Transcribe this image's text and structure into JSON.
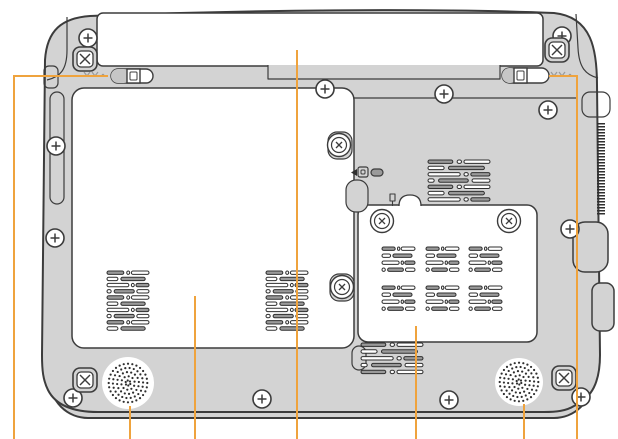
{
  "canvas": {
    "w": 618,
    "h": 439
  },
  "figure": {
    "name": "notebook-bottom-view-illustration"
  },
  "palette": {
    "body": "#d3d3d3",
    "outline": "#3c3c3c",
    "white": "#ffffff",
    "slot": "#9a9a9a",
    "knob_shade": "#c6c6c6",
    "dark": "#2f2f2f",
    "callout": "#efa33d"
  },
  "body": {
    "wall": {
      "x": 50,
      "y": 320,
      "w": 542,
      "h": 98,
      "r": 38
    },
    "outline_d": "M90,16 C250,10 430,8 554,13 C592,17 597,50 597,85 L600,355 C600,382 592,398 574,406 C566,411 556,412 544,412 L98,412 C74,412 56,406 48,390 C43,380 42,370 42,355 L45,60 C47,30 62,18 90,16 Z"
  },
  "battery": {
    "name": "battery-pack",
    "x": 97,
    "y": 13,
    "w": 446,
    "h": 53,
    "r": 6
  },
  "covers": [
    {
      "name": "hard-disk-compartment-cover",
      "x": 72,
      "y": 88,
      "w": 282,
      "h": 260,
      "r": 12
    },
    {
      "name": "memory-compartment-cover",
      "x": 358,
      "y": 205,
      "w": 179,
      "h": 137,
      "r": 10
    }
  ],
  "details_under": [
    {
      "name": "left-edge-tab",
      "type": "rrect",
      "x": 44,
      "y": 66,
      "w": 14,
      "h": 22,
      "r": 5,
      "sw": 1.2
    },
    {
      "name": "left-edge-strip",
      "type": "rrect",
      "x": 50,
      "y": 92,
      "w": 14,
      "h": 112,
      "r": 7,
      "sw": 1.2
    },
    {
      "name": "corner-contour-left",
      "type": "path",
      "d": "M67,17 L67,50 C67,70 60,77 47,80",
      "sw": 1.2
    },
    {
      "name": "corner-contour-right",
      "type": "path",
      "d": "M576,14 L578,48 C579,68 586,75 598,78",
      "sw": 1.2
    },
    {
      "name": "right-top-tab",
      "type": "rrect",
      "x": 582,
      "y": 92,
      "w": 28,
      "h": 25,
      "r": 8,
      "sw": 1.2
    },
    {
      "name": "right-side-ribs",
      "type": "ribs",
      "x": 597,
      "y": 123,
      "w": 8,
      "count": 31,
      "gap": 3
    },
    {
      "name": "right-bulge",
      "type": "rrect",
      "x": 573,
      "y": 222,
      "w": 35,
      "h": 50,
      "r": 12,
      "sw": 1.5,
      "fill": "body"
    },
    {
      "name": "right-lower-bulge",
      "type": "rrect",
      "x": 592,
      "y": 283,
      "w": 22,
      "h": 48,
      "r": 8,
      "sw": 1.5,
      "fill": "body"
    },
    {
      "name": "body-contour-right-of-cover",
      "type": "path",
      "d": "M342,88 L342,98 L576,98",
      "sw": 1.2
    }
  ],
  "details_over": [
    {
      "name": "battery-step",
      "type": "path",
      "d": "M268,65 L268,79 L500,79 L500,65",
      "sw": 1.2,
      "fill": "body",
      "fillclose": true
    },
    {
      "name": "cover-screw-boss-top",
      "type": "rrect",
      "x": 328,
      "y": 132,
      "w": 24,
      "h": 27,
      "r": 9,
      "sw": 1.2,
      "fill": "body"
    },
    {
      "name": "cover-screw-boss-bottom",
      "type": "rrect",
      "x": 330,
      "y": 274,
      "w": 24,
      "h": 27,
      "r": 9,
      "sw": 1.2,
      "fill": "body"
    },
    {
      "name": "thumb-recess",
      "type": "rrect",
      "x": 346,
      "y": 180,
      "w": 22,
      "h": 32,
      "r": 10,
      "sw": 1.2,
      "fill": "body"
    },
    {
      "name": "oval-tab",
      "type": "rrect",
      "x": 352,
      "y": 346,
      "w": 14,
      "h": 24,
      "r": 7,
      "sw": 1.2,
      "fill": "body"
    },
    {
      "name": "memory-cover-notch",
      "type": "path",
      "d": "M399,206 Q399,195 410,195 Q421,195 421,206",
      "sw": 1.3,
      "fill": "white"
    },
    {
      "name": "battery-lock-arrow-icon",
      "type": "path",
      "d": "M357,169 L351,172.5 L357,176 Z",
      "fill": "dark",
      "sw": 0
    },
    {
      "name": "battery-lock-box-icon",
      "type": "rrect",
      "x": 358,
      "y": 167,
      "w": 10,
      "h": 10,
      "r": 2,
      "sw": 1.2
    },
    {
      "name": "battery-lock-box-inner-icon",
      "type": "rrect",
      "x": 361,
      "y": 170,
      "w": 4,
      "h": 4,
      "r": 1,
      "sw": 1
    },
    {
      "name": "battery-lock-pill-icon",
      "type": "rrect",
      "x": 371,
      "y": 169,
      "w": 12,
      "h": 7,
      "r": 3.5,
      "sw": 1.2,
      "fill": "slot"
    },
    {
      "name": "pin-icon",
      "type": "path",
      "d": "M390,194 h5 v7 h-5 Z M392.5,201 L392.5,206",
      "sw": 1.1
    }
  ],
  "grilles": [
    {
      "name": "hdd-cover-vent-left",
      "x": 107,
      "y": 271,
      "w": 42,
      "h": 62,
      "rows": 10
    },
    {
      "name": "hdd-cover-vent-right",
      "x": 266,
      "y": 271,
      "w": 42,
      "h": 62,
      "rows": 10
    },
    {
      "name": "memory-cover-vent-1",
      "x": 382,
      "y": 247,
      "w": 33,
      "h": 28,
      "rows": 4
    },
    {
      "name": "memory-cover-vent-2",
      "x": 426,
      "y": 247,
      "w": 33,
      "h": 28,
      "rows": 4
    },
    {
      "name": "memory-cover-vent-3",
      "x": 469,
      "y": 247,
      "w": 33,
      "h": 28,
      "rows": 4
    },
    {
      "name": "memory-cover-vent-4",
      "x": 382,
      "y": 286,
      "w": 33,
      "h": 28,
      "rows": 4
    },
    {
      "name": "memory-cover-vent-5",
      "x": 426,
      "y": 286,
      "w": 33,
      "h": 28,
      "rows": 4
    },
    {
      "name": "memory-cover-vent-6",
      "x": 469,
      "y": 286,
      "w": 33,
      "h": 28,
      "rows": 4
    },
    {
      "name": "body-vent-upper",
      "x": 428,
      "y": 160,
      "w": 62,
      "h": 44,
      "rows": 7
    },
    {
      "name": "body-vent-lower",
      "x": 361,
      "y": 343,
      "w": 62,
      "h": 34,
      "rows": 5
    }
  ],
  "speakers": [
    {
      "name": "speaker-left",
      "cx": 128,
      "cy": 383,
      "r": 26
    },
    {
      "name": "speaker-right",
      "cx": 519,
      "cy": 382,
      "r": 24
    }
  ],
  "screws": {
    "phillips": [
      [
        88,
        38
      ],
      [
        562,
        36
      ],
      [
        56,
        146
      ],
      [
        55,
        238
      ],
      [
        325,
        89
      ],
      [
        444,
        94
      ],
      [
        548,
        110
      ],
      [
        570,
        229
      ],
      [
        73,
        398
      ],
      [
        262,
        399
      ],
      [
        449,
        400
      ],
      [
        581,
        397
      ]
    ],
    "lock": [
      [
        339,
        145
      ],
      [
        342,
        287
      ],
      [
        382,
        221
      ],
      [
        509,
        221
      ]
    ],
    "bumper": [
      [
        85,
        59
      ],
      [
        557,
        50
      ],
      [
        85,
        380
      ],
      [
        564,
        378
      ]
    ]
  },
  "latches": [
    {
      "name": "battery-latch-spring",
      "x": 111,
      "y": 69,
      "w": 42,
      "h": 14,
      "knob": 127,
      "knobw": 13
    },
    {
      "name": "battery-latch-manual",
      "x": 502,
      "y": 68,
      "w": 47,
      "h": 15,
      "knob": 514,
      "knobw": 13
    }
  ],
  "latch_marks": [
    {
      "name": "latch-marks-left",
      "x": 84,
      "y": 72
    },
    {
      "name": "latch-marks-right",
      "x": 551,
      "y": 72
    }
  ],
  "callouts": [
    {
      "target": "battery-latch-spring",
      "points": [
        [
          14,
          439
        ],
        [
          14,
          76
        ],
        [
          108,
          76
        ]
      ]
    },
    {
      "target": "speaker-left",
      "points": [
        [
          130,
          439
        ],
        [
          130,
          406
        ]
      ]
    },
    {
      "target": "hard-disk-compartment-cover",
      "points": [
        [
          195,
          439
        ],
        [
          195,
          296
        ]
      ]
    },
    {
      "target": "battery-pack",
      "points": [
        [
          297,
          439
        ],
        [
          297,
          50
        ]
      ]
    },
    {
      "target": "memory-compartment-cover",
      "points": [
        [
          416,
          439
        ],
        [
          416,
          326
        ]
      ]
    },
    {
      "target": "speaker-right",
      "points": [
        [
          524,
          439
        ],
        [
          524,
          404
        ]
      ]
    },
    {
      "target": "battery-latch-manual",
      "points": [
        [
          577,
          439
        ],
        [
          577,
          76
        ],
        [
          549,
          76
        ]
      ]
    }
  ]
}
